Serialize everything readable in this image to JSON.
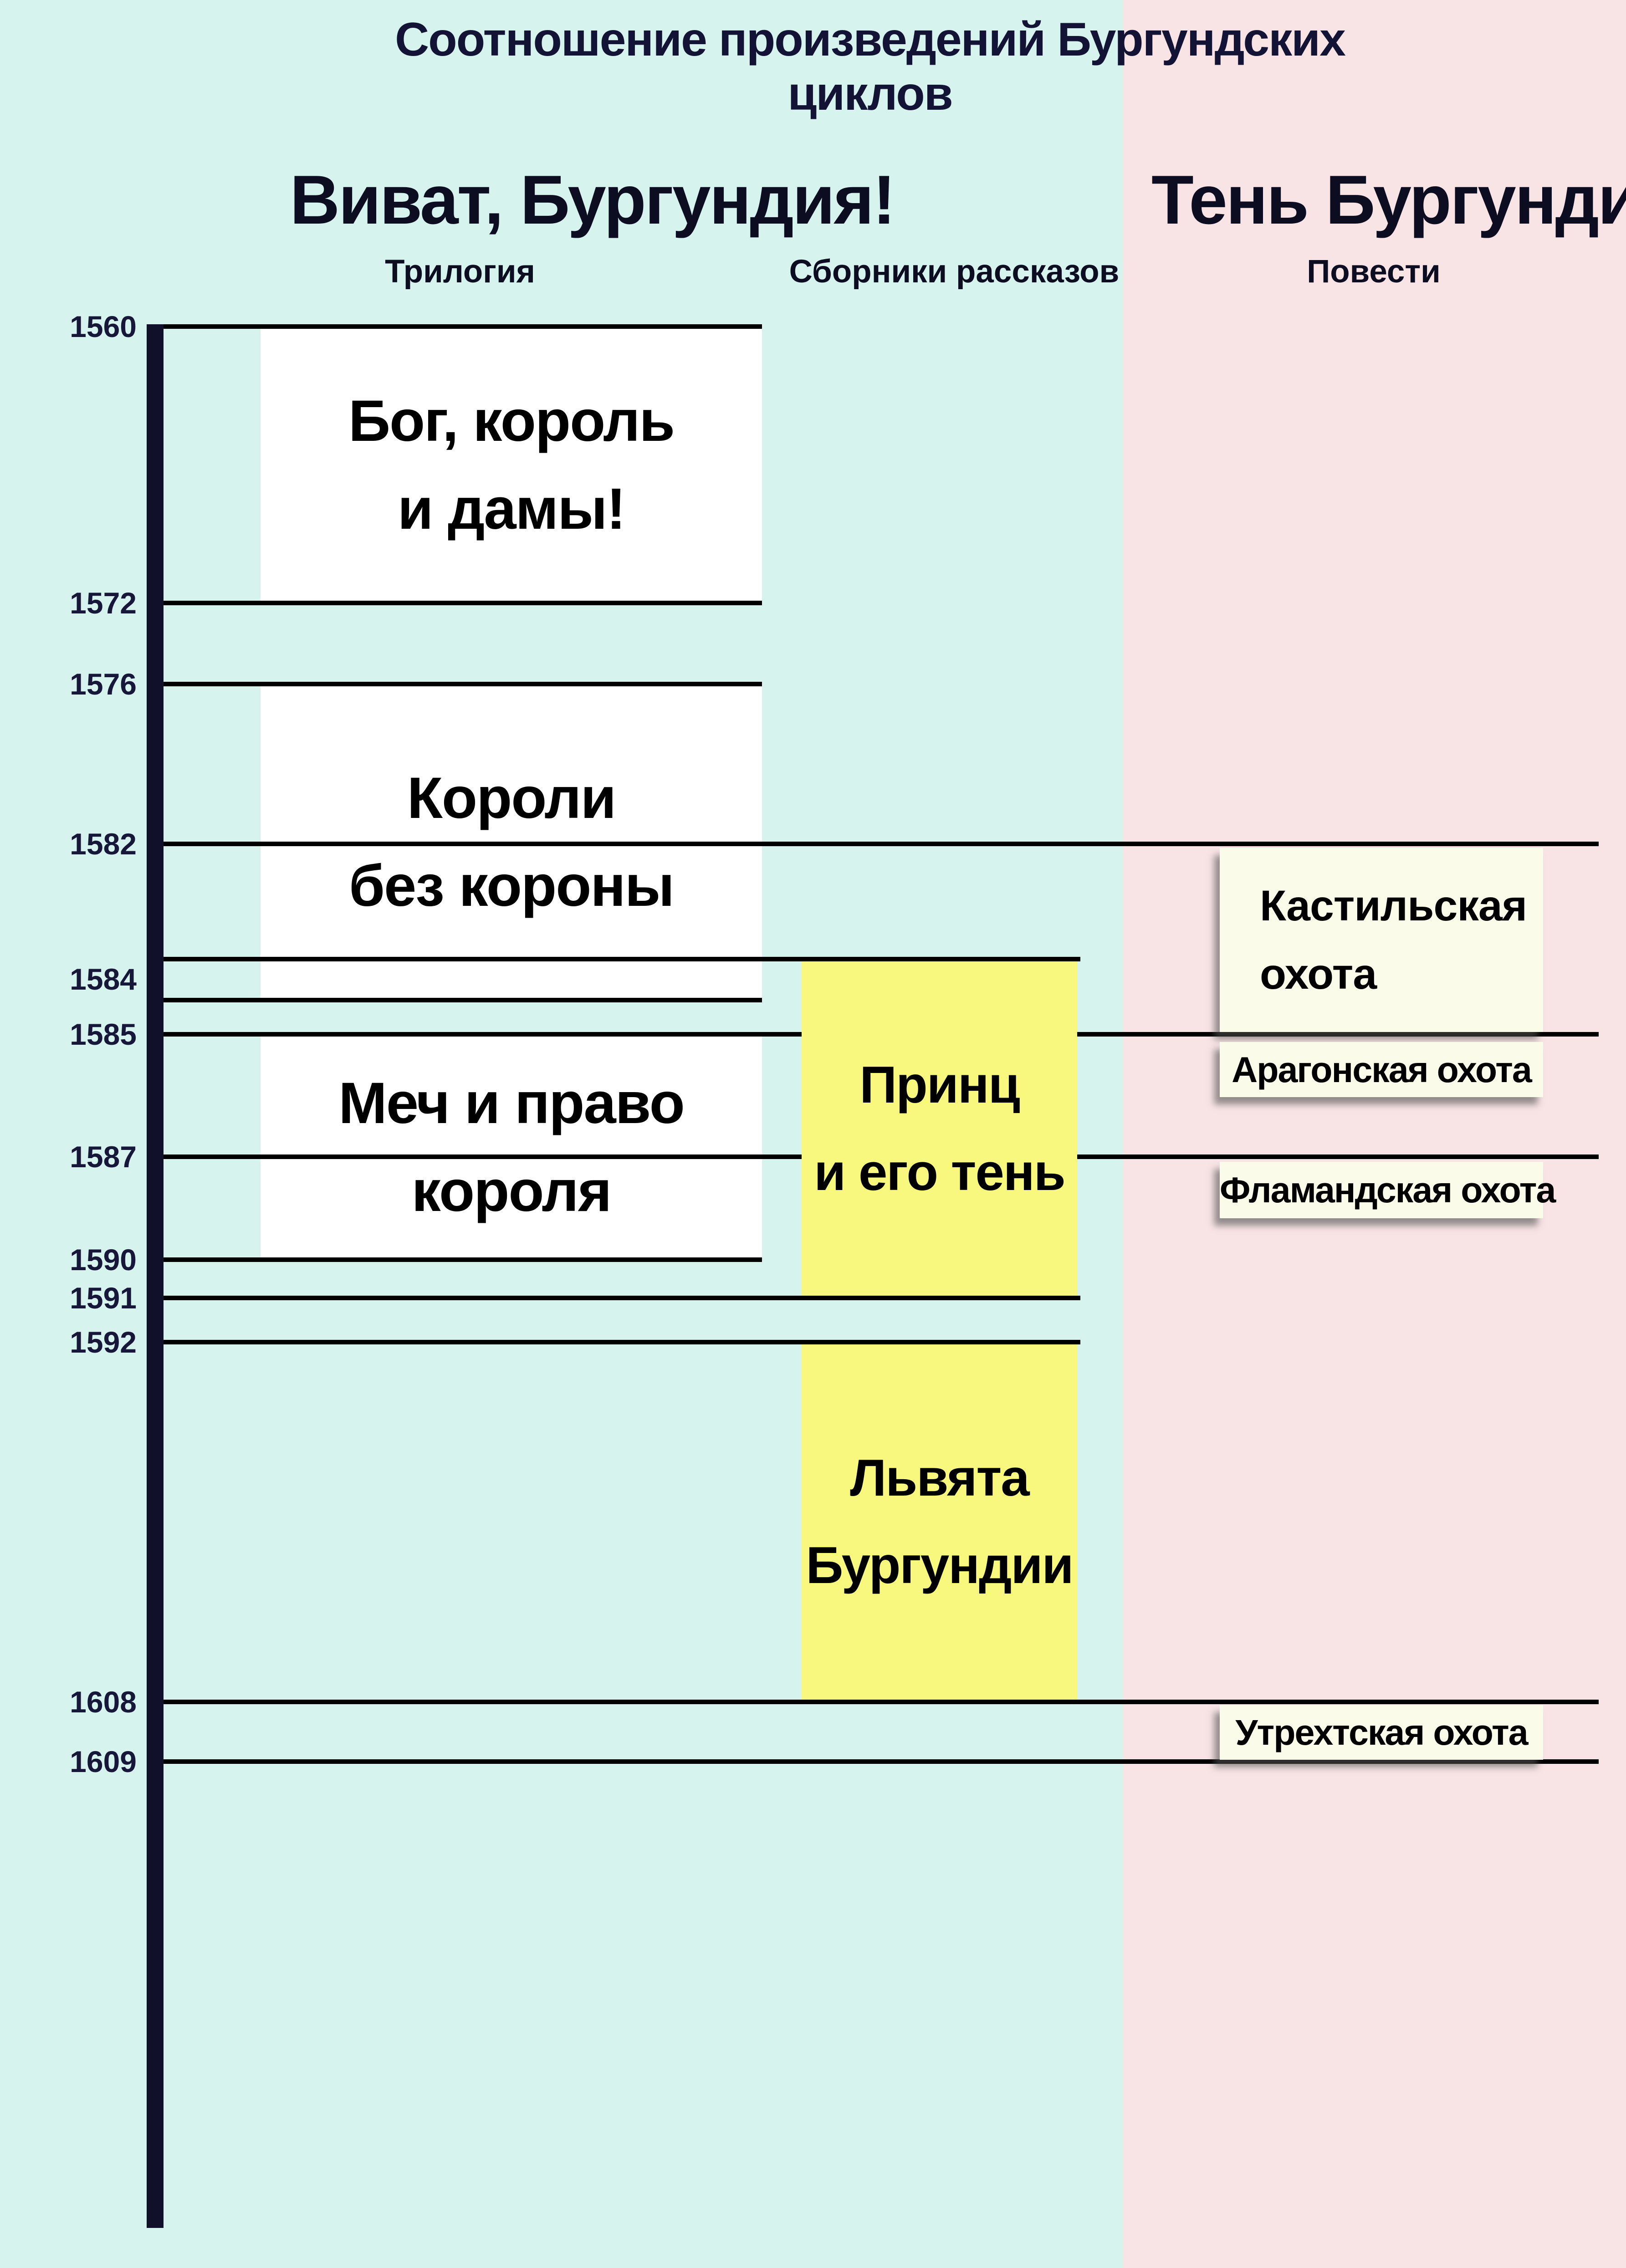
{
  "title": "Соотношение произведений Бургундских циклов",
  "cycles": [
    {
      "title": "Виват, Бургундия!",
      "columns": [
        "Трилогия",
        "Сборники рассказов"
      ]
    },
    {
      "title": "Тень Бургундии",
      "columns": [
        "Повести"
      ]
    }
  ],
  "column_labels": [
    "Трилогия",
    "Сборники рассказов",
    "Повести"
  ],
  "year_ticks": [
    "1560",
    "1572",
    "1576",
    "1582",
    "1584",
    "1585",
    "1587",
    "1590",
    "1591",
    "1592",
    "1608",
    "1609"
  ],
  "works": {
    "trilogy": [
      {
        "lines": [
          "Бог, король",
          "и дамы!"
        ],
        "start": 1560,
        "end": 1572
      },
      {
        "lines": [
          "Короли",
          "без короны"
        ],
        "start": 1576,
        "end": 1584
      },
      {
        "lines": [
          "Меч и право",
          "короля"
        ],
        "start": 1585,
        "end": 1590
      }
    ],
    "collections": [
      {
        "lines": [
          "Принц",
          "и его тень"
        ],
        "start": 1584,
        "end": 1591
      },
      {
        "lines": [
          "Львята",
          "Бургундии"
        ],
        "start": 1592,
        "end": 1608
      }
    ],
    "novellas": [
      {
        "lines": [
          "Кастильская",
          "охота"
        ],
        "start": 1582,
        "end": 1585
      },
      {
        "lines": [
          "Арагонская охота"
        ],
        "start": 1585,
        "end": null
      },
      {
        "lines": [
          "Фламандская охота"
        ],
        "start": 1587,
        "end": null
      },
      {
        "lines": [
          "Утрехтская охота"
        ],
        "start": 1608,
        "end": 1609
      }
    ]
  },
  "colors": {
    "vivat_background": "#d7f3ee",
    "ten_background": "#f8e4e5",
    "trilogy_box": "#ffffff",
    "collections_box": "#f7f87d",
    "novellas_box": "#fbfbe9",
    "axis": "#10102b",
    "year_label": "#17173a",
    "line": "#000000",
    "text": "#000000",
    "title_text": "#131335"
  },
  "chart_data": {
    "type": "bar",
    "subtype": "vertical-gantt-timeline",
    "title": "Соотношение произведений Бургундских циклов",
    "axis": {
      "orientation": "vertical",
      "unit": "year",
      "ticks": [
        1560,
        1572,
        1576,
        1582,
        1584,
        1585,
        1587,
        1590,
        1591,
        1592,
        1608,
        1609
      ],
      "range_shown": [
        1560,
        1609
      ],
      "to_scale": false
    },
    "groups": [
      {
        "name": "Виват, Бургундия!",
        "columns": [
          {
            "name": "Трилогия",
            "items": [
              {
                "label": "Бог, король и дамы!",
                "start": 1560,
                "end": 1572
              },
              {
                "label": "Короли без короны",
                "start": 1576,
                "end": 1584
              },
              {
                "label": "Меч и право короля",
                "start": 1585,
                "end": 1590
              }
            ]
          },
          {
            "name": "Сборники рассказов",
            "items": [
              {
                "label": "Принц и его тень",
                "start": 1584,
                "end": 1591
              },
              {
                "label": "Львята Бургундии",
                "start": 1592,
                "end": 1608
              }
            ]
          }
        ]
      },
      {
        "name": "Тень Бургундии",
        "columns": [
          {
            "name": "Повести",
            "items": [
              {
                "label": "Кастильская охота",
                "start": 1582,
                "end": 1585
              },
              {
                "label": "Арагонская охота",
                "start": 1585,
                "end": null
              },
              {
                "label": "Фламандская охота",
                "start": 1587,
                "end": null
              },
              {
                "label": "Утрехтская охота",
                "start": 1608,
                "end": 1609
              }
            ]
          }
        ]
      }
    ],
    "legend_position": "none",
    "grid": false
  }
}
